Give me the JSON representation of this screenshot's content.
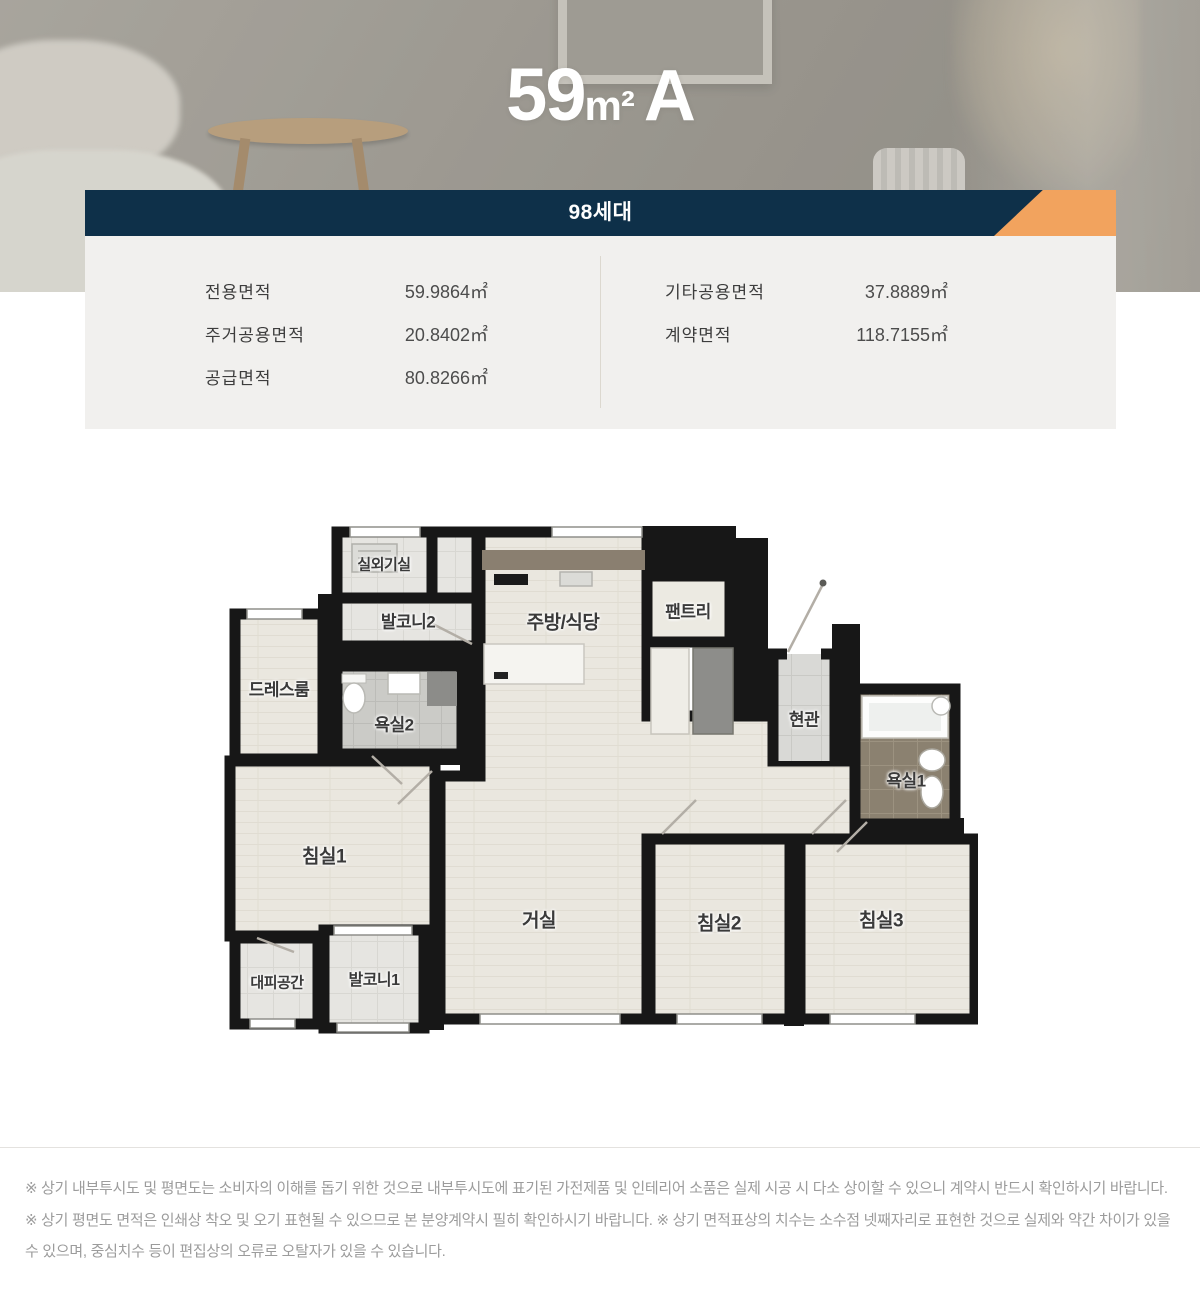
{
  "hero": {
    "title_number": "59",
    "title_unit": "m²",
    "title_letter": "A"
  },
  "banner": {
    "units_label": "98세대",
    "bg_color": "#0e3049",
    "accent_color": "#f2a35e"
  },
  "area_panel": {
    "left_rows": [
      {
        "label": "전용면적",
        "value": "59.9864㎡"
      },
      {
        "label": "주거공용면적",
        "value": "20.8402㎡"
      },
      {
        "label": "공급면적",
        "value": "80.8266㎡"
      }
    ],
    "right_rows": [
      {
        "label": "기타공용면적",
        "value": "37.8889㎡"
      },
      {
        "label": "계약면적",
        "value": "118.7155㎡"
      }
    ]
  },
  "floorplan": {
    "canvas_width": 756,
    "canvas_height": 516,
    "rooms": [
      {
        "id": "outdoor-unit-room",
        "name": "실외기실",
        "x": 162,
        "y": 38,
        "size": 15
      },
      {
        "id": "balcony2",
        "name": "발코니2",
        "x": 186,
        "y": 94,
        "size": 17
      },
      {
        "id": "kitchen-dining",
        "name": "주방/식당",
        "x": 341,
        "y": 95,
        "size": 19
      },
      {
        "id": "pantry",
        "name": "팬트리",
        "x": 466,
        "y": 84,
        "size": 17
      },
      {
        "id": "dressroom",
        "name": "드레스룸",
        "x": 57,
        "y": 162,
        "size": 17
      },
      {
        "id": "bathroom2",
        "name": "욕실2",
        "x": 172,
        "y": 197,
        "size": 17
      },
      {
        "id": "entrance",
        "name": "현관",
        "x": 582,
        "y": 192,
        "size": 17
      },
      {
        "id": "bathroom1",
        "name": "욕실1",
        "x": 684,
        "y": 253,
        "size": 17
      },
      {
        "id": "bedroom1",
        "name": "침실1",
        "x": 102,
        "y": 329,
        "size": 19
      },
      {
        "id": "living",
        "name": "거실",
        "x": 317,
        "y": 393,
        "size": 19
      },
      {
        "id": "bedroom2",
        "name": "침실2",
        "x": 497,
        "y": 396,
        "size": 19
      },
      {
        "id": "bedroom3",
        "name": "침실3",
        "x": 659,
        "y": 393,
        "size": 19
      },
      {
        "id": "refuge-space",
        "name": "대피공간",
        "x": 55,
        "y": 456,
        "size": 15
      },
      {
        "id": "balcony1",
        "name": "발코니1",
        "x": 152,
        "y": 452,
        "size": 16
      }
    ]
  },
  "disclaimer": {
    "text": "※ 상기 내부투시도 및 평면도는 소비자의 이해를 돕기 위한 것으로 내부투시도에 표기된 가전제품 및 인테리어 소품은 실제 시공 시 다소 상이할 수 있으니 계약시 반드시 확인하시기 바랍니다. ※ 상기 평면도 면적은 인쇄상 착오 및 오기 표현될 수 있으므로 본 분양계약시 필히 확인하시기 바랍니다. ※ 상기 면적표상의 치수는 소수점 넷째자리로 표현한 것으로 실제와 약간 차이가 있을 수 있으며, 중심치수 등이 편집상의 오류로 오탈자가 있을 수 있습니다."
  }
}
